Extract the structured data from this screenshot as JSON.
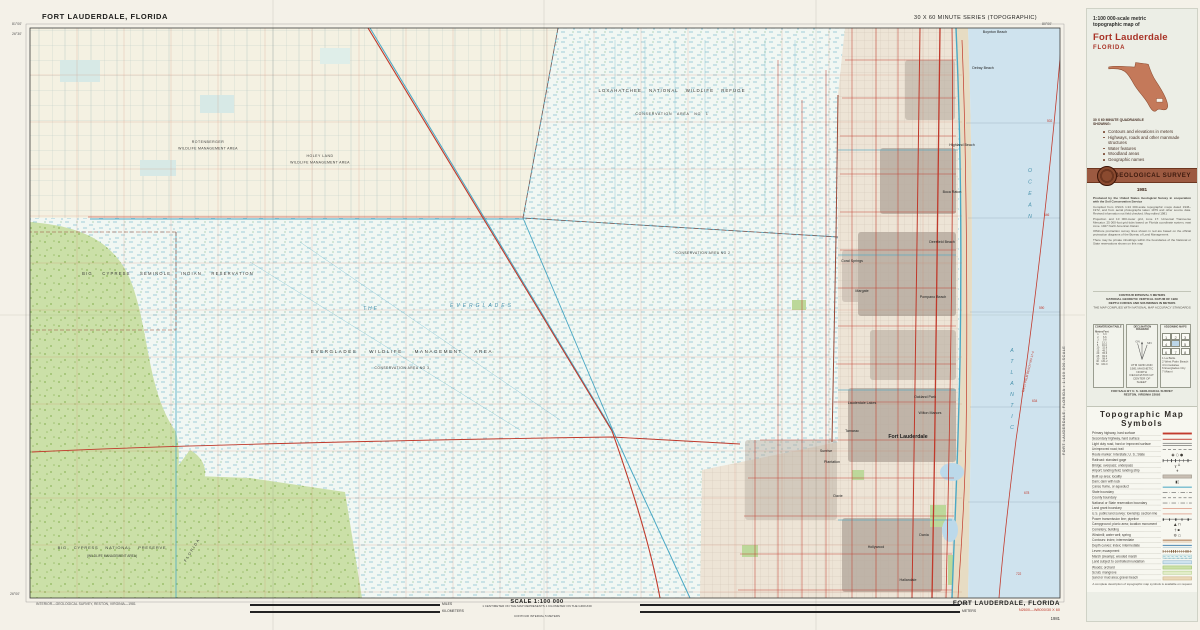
{
  "map": {
    "corner_title": "FORT LAUDERDALE, FLORIDA",
    "series": "30 X 60 MINUTE SERIES (TOPOGRAPHIC)",
    "corners": {
      "tl_lon": "81°00'",
      "tl_lat": "26°30'",
      "tr_lon": "80°00'",
      "bl_lat": "26°00'"
    },
    "labels": [
      {
        "t": "LOXAHATCHEE  NATIONAL  WILDLIFE  REFUGE",
        "x": 672,
        "y": 92,
        "fs": 4.4,
        "ls": 1,
        "ws": 5,
        "anc": "middle"
      },
      {
        "t": "CONSERVATION  AREA  NO 1",
        "x": 672,
        "y": 115,
        "fs": 3.5,
        "ls": 0.8,
        "ws": 3,
        "anc": "middle"
      },
      {
        "t": "ROTENBERGER",
        "x": 208,
        "y": 143,
        "fs": 3.5,
        "ls": 0.5,
        "anc": "middle"
      },
      {
        "t": "WILDLIFE  MANAGEMENT  AREA",
        "x": 208,
        "y": 149.5,
        "fs": 3.5,
        "ls": 0.3,
        "anc": "middle"
      },
      {
        "t": "HOLEY  LAND",
        "x": 320,
        "y": 157,
        "fs": 3.5,
        "ls": 0.5,
        "anc": "middle"
      },
      {
        "t": "WILDLIFE  MANAGEMENT  AREA",
        "x": 320,
        "y": 163.5,
        "fs": 3.5,
        "ls": 0.3,
        "anc": "middle"
      },
      {
        "t": "BIG   CYPRESS   SEMINOLE   INDIAN   RESERVATION",
        "x": 168,
        "y": 275,
        "fs": 4.2,
        "ls": 1.2,
        "ws": 7,
        "anc": "middle"
      },
      {
        "t": "THE",
        "x": 363,
        "y": 310,
        "fs": 5,
        "col": "#4a93ad",
        "it": 1,
        "ls": 2
      },
      {
        "t": "EVERGLADES",
        "x": 482,
        "y": 307,
        "fs": 5,
        "col": "#4a93ad",
        "it": 1,
        "ls": 3,
        "anc": "middle"
      },
      {
        "t": "EVERGLADES    WILDLIFE    MANAGEMENT    AREA",
        "x": 402,
        "y": 353,
        "fs": 4.5,
        "ls": 1.6,
        "ws": 9,
        "anc": "middle"
      },
      {
        "t": "CONSERVATION AREA NO 3",
        "x": 402,
        "y": 369,
        "fs": 3.3,
        "ls": 0.5,
        "anc": "middle"
      },
      {
        "t": "CONSERVATION AREA NO 2",
        "x": 703,
        "y": 254,
        "fs": 3.3,
        "ls": 0.5,
        "anc": "middle"
      },
      {
        "t": "BIG  CYPRESS  NATIONAL  PRESERVE",
        "x": 112,
        "y": 549,
        "fs": 4,
        "ls": 0.8,
        "ws": 5,
        "anc": "middle"
      },
      {
        "t": "(WILDLIFE  MANAGEMENT  AREA)",
        "x": 112,
        "y": 557,
        "fs": 3.2,
        "anc": "middle"
      },
      {
        "t": "FLORIDA",
        "x": 186,
        "y": 562,
        "fs": 3.8,
        "ls": 1.5,
        "rot": -58
      },
      {
        "t": "OCEAN",
        "x": 1030,
        "y": 172,
        "fs": 5.2,
        "col": "#4a93ad",
        "it": 1,
        "st": 1,
        "dy": 11.5
      },
      {
        "t": "ATLANTIC",
        "x": 1012,
        "y": 352,
        "fs": 5.2,
        "col": "#4a93ad",
        "it": 1,
        "st": 1,
        "dy": 11
      },
      {
        "t": "WEST PALM BEACH NG 17-4",
        "x": 1029,
        "y": 372,
        "fs": 3.1,
        "col": "#c0392b",
        "rot": -76,
        "anc": "middle"
      },
      {
        "t": "502",
        "x": 1047,
        "y": 122,
        "fs": 3.2,
        "col": "#c0392b"
      },
      {
        "t": "546",
        "x": 1044,
        "y": 216,
        "fs": 3.2,
        "col": "#c0392b"
      },
      {
        "t": "590",
        "x": 1039,
        "y": 309,
        "fs": 3.2,
        "col": "#c0392b"
      },
      {
        "t": "634",
        "x": 1032,
        "y": 402,
        "fs": 3.2,
        "col": "#c0392b"
      },
      {
        "t": "678",
        "x": 1024,
        "y": 494,
        "fs": 3.2,
        "col": "#c0392b"
      },
      {
        "t": "722",
        "x": 1016,
        "y": 575,
        "fs": 3.2,
        "col": "#c0392b"
      }
    ],
    "cities": [
      {
        "t": "Boynton Beach",
        "x": 995,
        "y": 33
      },
      {
        "t": "Delray Beach",
        "x": 983,
        "y": 69
      },
      {
        "t": "Highland Beach",
        "x": 962,
        "y": 146
      },
      {
        "t": "Boca Raton",
        "x": 952,
        "y": 193
      },
      {
        "t": "Deerfield Beach",
        "x": 942,
        "y": 243
      },
      {
        "t": "Pompano Beach",
        "x": 933,
        "y": 298
      },
      {
        "t": "Coral Springs",
        "x": 852,
        "y": 262
      },
      {
        "t": "Margate",
        "x": 862,
        "y": 292
      },
      {
        "t": "Lauderdale Lakes",
        "x": 862,
        "y": 404
      },
      {
        "t": "Oakland Park",
        "x": 925,
        "y": 398
      },
      {
        "t": "Wilton Manors",
        "x": 930,
        "y": 414
      },
      {
        "t": "Tamarac",
        "x": 852,
        "y": 432
      },
      {
        "t": "Sunrise",
        "x": 826,
        "y": 452
      },
      {
        "t": "Plantation",
        "x": 832,
        "y": 463
      },
      {
        "t": "Fort Lauderdale",
        "x": 908,
        "y": 438,
        "fs": 5.2,
        "b": 1
      },
      {
        "t": "Davie",
        "x": 838,
        "y": 497
      },
      {
        "t": "Dania",
        "x": 924,
        "y": 536
      },
      {
        "t": "Hollywood",
        "x": 876,
        "y": 548
      },
      {
        "t": "Hallandale",
        "x": 908,
        "y": 581
      }
    ]
  },
  "footer": {
    "credit": "INTERIOR—GEOLOGICAL SURVEY, RESTON, VIRGINIA—1981",
    "scale_title": "SCALE 1:100 000",
    "scale_note1": "1 CENTIMETER ON THE MAP REPRESENTS 1 KILOMETER ON THE GROUND",
    "scale_note2": "CONTOUR INTERVAL 5 METERS",
    "units": [
      "MILES",
      "KILOMETERS",
      "FEET",
      "METERS"
    ],
    "sheet_name": "FORT LAUDERDALE, FLORIDA",
    "sheet_id": "N2600—W8000/30 X 60",
    "year": "1981",
    "edge_label": "FORT LAUDERDALE, FLORIDA • 1:100 000-SCALE"
  },
  "panel": {
    "title_line1": "1:100 000-scale metric",
    "title_line2": "topographic map of",
    "map_name": "Fort Lauderdale",
    "state": "FLORIDA",
    "quad_note1": "30 X 60 MINUTE QUADRANGLE",
    "quad_note2": "SHOWING:",
    "bullets": [
      "Contours and elevations in meters",
      "Highways, roads and other manmade structures",
      "Water features",
      "Woodland areas",
      "Geographic names"
    ],
    "agency": "GEOLOGICAL SURVEY",
    "year": "1981",
    "credits": [
      "Produced by the United States Geological Survey in cooperation with the Soil Conservation Service",
      "Compiled from USGS 1:24 000-scale topographic maps dated 1946–1972, and from aerial photographs taken 1979 and other source data. Revised information not field checked. Map edited 1981",
      "Projection and 10 000-meter grid, zone 17: Universal Transverse Mercator. 25 000-foot grid ticks based on Florida coordinate system, east zone. 1927 North American Datum",
      "Offshore protraction survey lines shown in red are based on the official protraction diagrams of the Bureau of Land Management",
      "There may be private inholdings within the boundaries of the National or State reservations shown on this map"
    ],
    "contour_lines": [
      "CONTOUR INTERVAL 5 METERS",
      "NATIONAL GEODETIC VERTICAL DATUM OF 1929",
      "DEPTH CURVES AND SOUNDINGS IN METERS"
    ],
    "accuracy": "THE MAP COMPLIES WITH NATIONAL MAP ACCURACY STANDARDS",
    "boxes": {
      "conversion": {
        "title": "CONVERSION TABLE",
        "col1": "Meters",
        "col2": "Feet",
        "rows": [
          [
            "1",
            "3.3"
          ],
          [
            "2",
            "6.6"
          ],
          [
            "3",
            "9.8"
          ],
          [
            "4",
            "13.1"
          ],
          [
            "5",
            "16.4"
          ],
          [
            "10",
            "32.8"
          ],
          [
            "15",
            "49.2"
          ],
          [
            "20",
            "65.6"
          ],
          [
            "25",
            "82.0"
          ],
          [
            "30",
            "98.4"
          ],
          [
            "40",
            "131.2"
          ],
          [
            "50",
            "164.0"
          ]
        ]
      },
      "declination": {
        "title": "DECLINATION DIAGRAM",
        "gn": "GN",
        "mn": "MN",
        "caption": "UTM GRID AND 1981 MAGNETIC NORTH DECLINATION AT CENTER OF SHEET"
      },
      "adjoining": {
        "title": "ADJOINING MAPS",
        "cells": [
          "1",
          "2",
          "3",
          "4",
          "",
          "5",
          "6",
          "7",
          "8"
        ],
        "key": [
          "1 La Belle",
          "2 West Palm Beach",
          "4 Immokalee",
          "6 Everglades City",
          "7 Miami"
        ]
      }
    },
    "sale": [
      "FOR SALE BY U. S. GEOLOGICAL SURVEY",
      "RESTON, VIRGINIA 22092"
    ],
    "symbols_title": "Topographic Map Symbols",
    "symbols": [
      {
        "label": "Primary highway, hard surface",
        "sw": "sw-redthick"
      },
      {
        "label": "Secondary highway, hard surface",
        "sw": "sw-redthin"
      },
      {
        "label": "Light duty road, hard or improved surface",
        "sw": "sw-dbl"
      },
      {
        "label": "Unimproved road; trail",
        "sw": "sw-dash"
      },
      {
        "label": "Route marker: Interstate; U. S.; State",
        "sw": "sw-glyph",
        "g": "◉ ○ ●"
      },
      {
        "label": "Railroad: standard gage",
        "sw": "sw-rail"
      },
      {
        "label": "Bridge; overpass; underpass",
        "sw": "sw-glyph",
        "g": "╥ ╨"
      },
      {
        "label": "Airport; landing field; landing strip",
        "sw": "sw-glyph",
        "g": "✈"
      },
      {
        "label": "Built up area; locality",
        "sw": "sw-gray"
      },
      {
        "label": "Dam; dam with lock",
        "sw": "sw-glyph",
        "g": "▮▯"
      },
      {
        "label": "Canal, flume, or aqueduct",
        "sw": "sw-canal"
      },
      {
        "label": "State boundary",
        "sw": "sw-dashdot"
      },
      {
        "label": "County boundary",
        "sw": "sw-dash"
      },
      {
        "label": "National or State reservation boundary",
        "sw": "sw-dashdot"
      },
      {
        "label": "Land grant boundary",
        "sw": "sw-redline"
      },
      {
        "label": "U.S. public land survey: township; section line",
        "sw": "sw-redline"
      },
      {
        "label": "Power transmission line; pipeline",
        "sw": "sw-power"
      },
      {
        "label": "Campground; picnic area; location monument",
        "sw": "sw-glyph",
        "g": "▲ ⊓"
      },
      {
        "label": "Cemetery; building",
        "sw": "sw-glyph",
        "g": "† ▪"
      },
      {
        "label": "Windmill; water well; spring",
        "sw": "sw-glyph",
        "g": "⚙ ○"
      },
      {
        "label": "Contours: index; intermediate",
        "sw": "sw-contour"
      },
      {
        "label": "Depth curves: index; intermediate",
        "sw": "sw-depth"
      },
      {
        "label": "Levee; escarpment",
        "sw": "sw-levee"
      },
      {
        "label": "Marsh (swamp); wooded marsh",
        "sw": "sw-marsh"
      },
      {
        "label": "Land subject to controlled inundation",
        "sw": "sw-blue"
      },
      {
        "label": "Woods; orchard",
        "sw": "sw-green"
      },
      {
        "label": "Scrub; mangrove",
        "sw": "sw-greenlt"
      },
      {
        "label": "Sand or mud area; gravel beach",
        "sw": "sw-tan"
      }
    ],
    "symbols_note": "A complete description of topographic map symbols is available on request"
  }
}
